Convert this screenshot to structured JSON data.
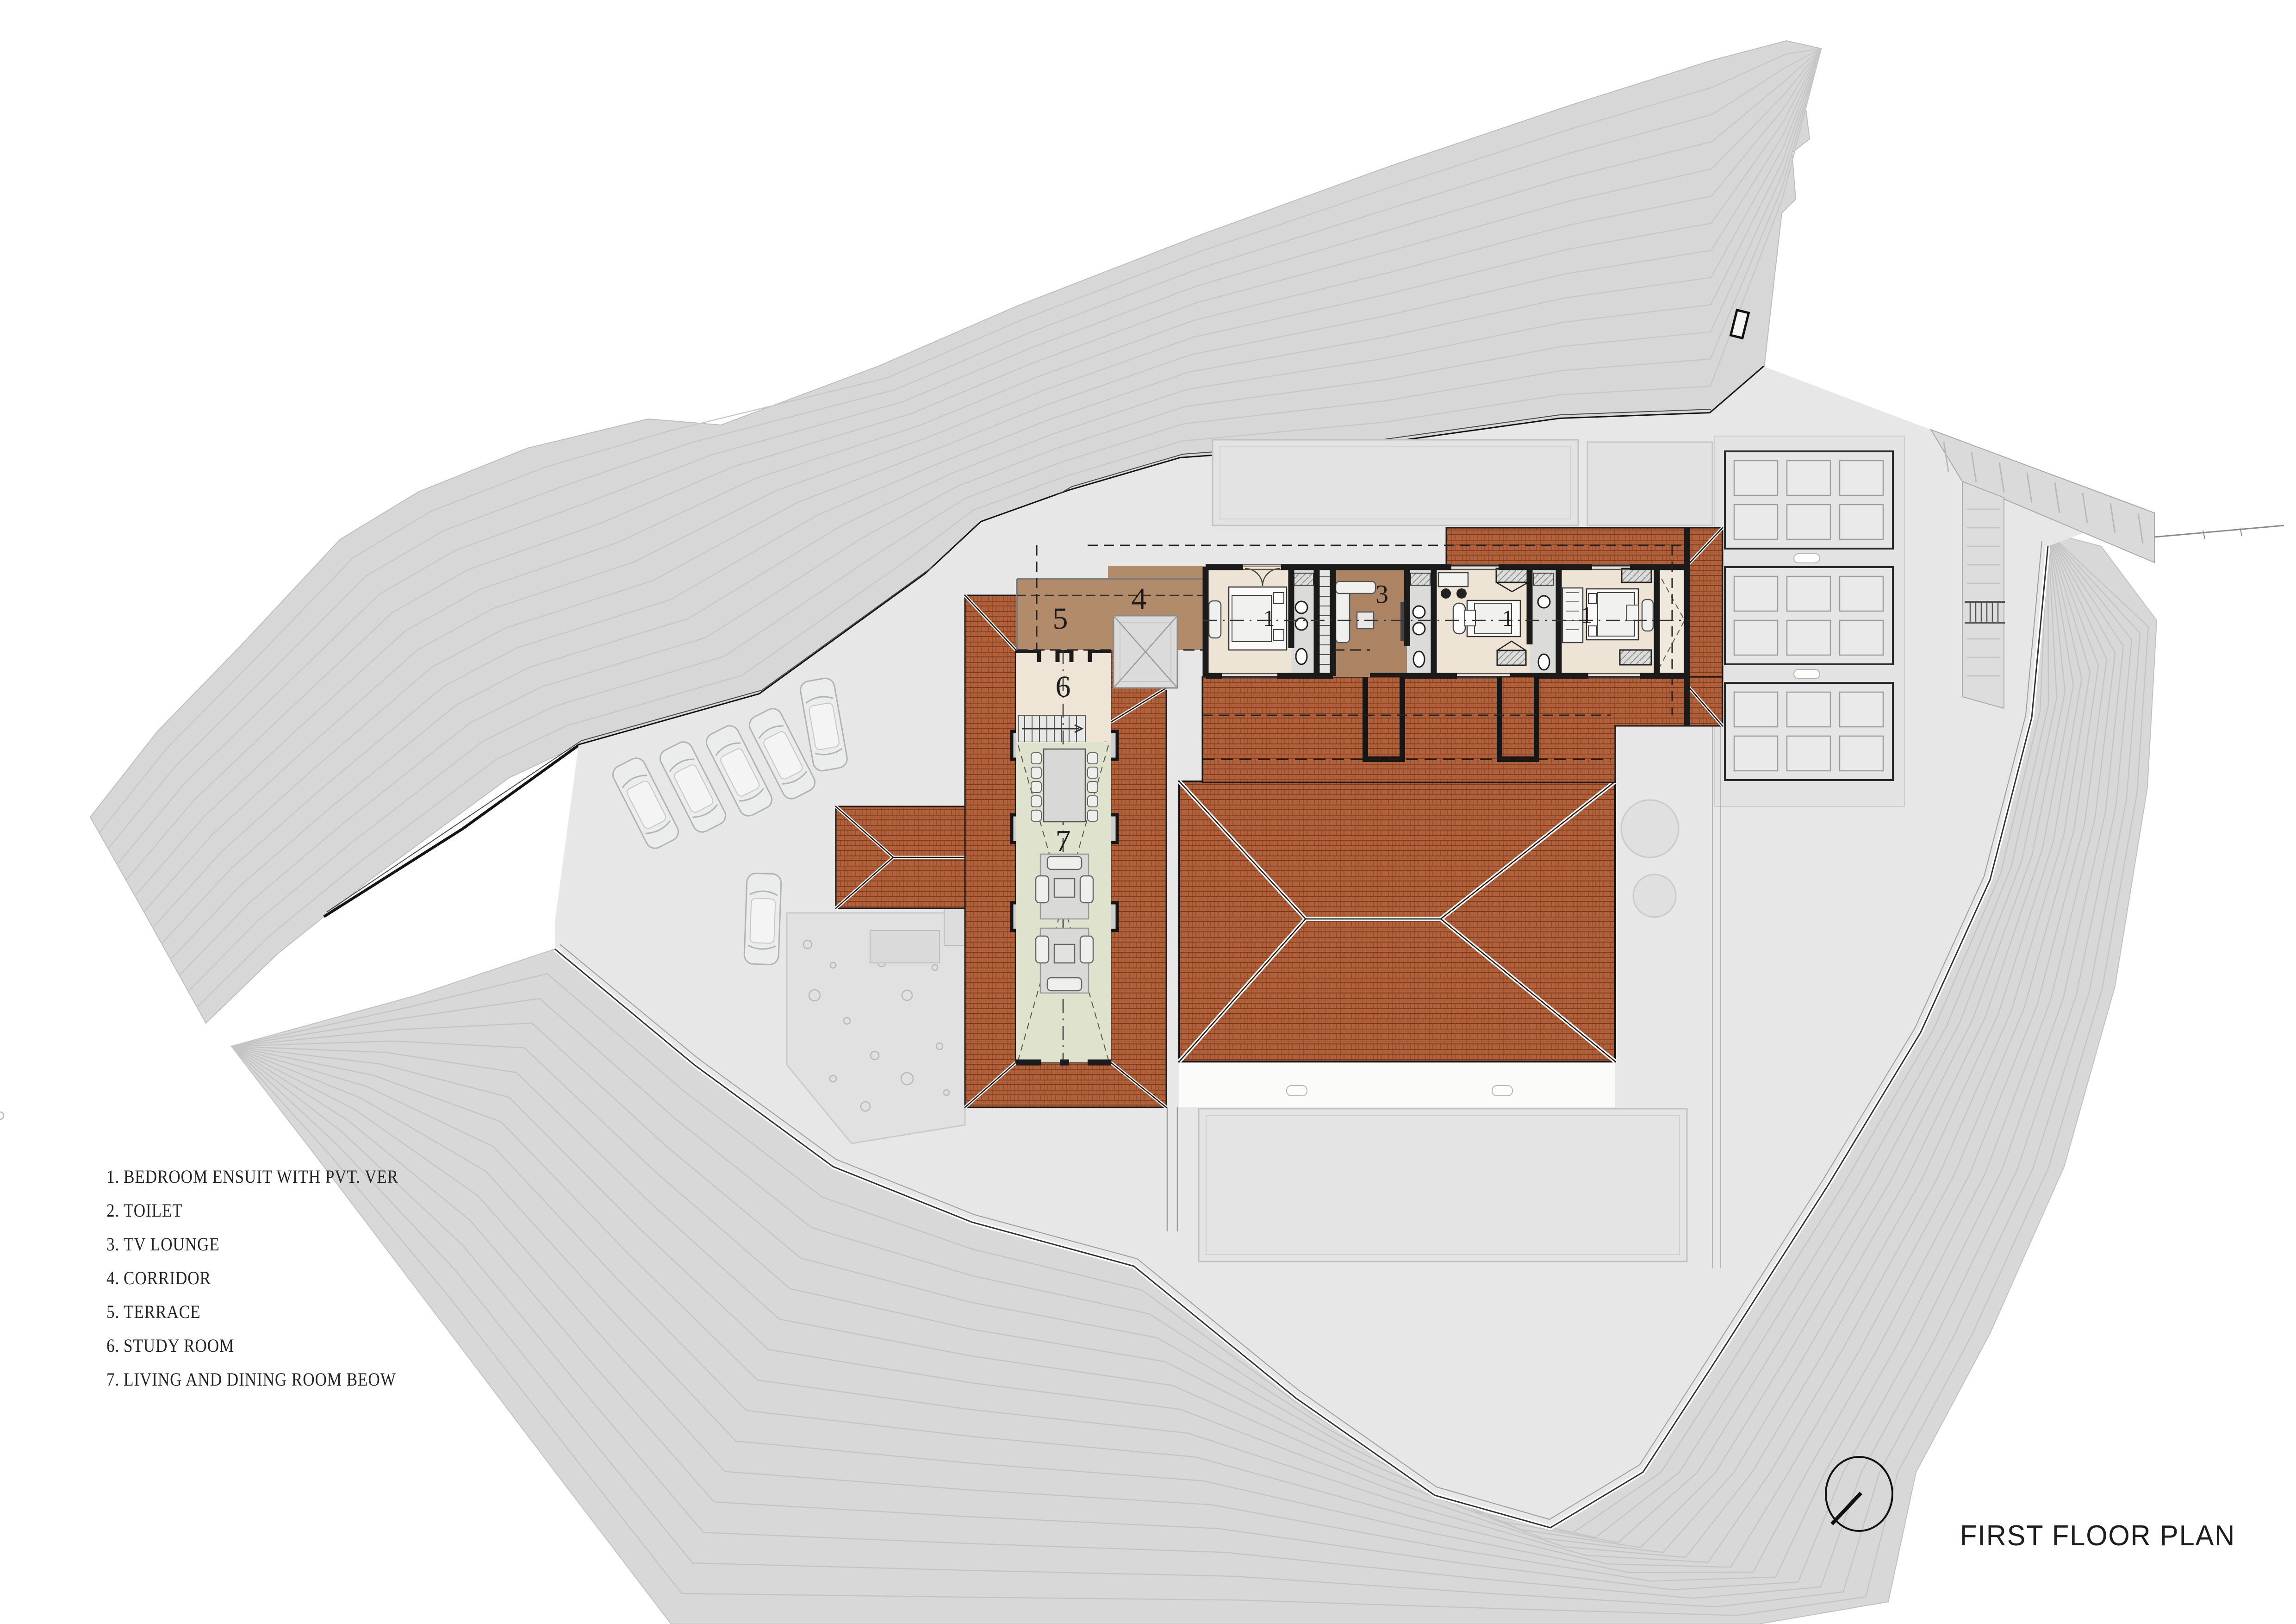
{
  "title": "FIRST FLOOR PLAN",
  "legend": {
    "items": [
      {
        "num": "1.",
        "text": "BEDROOM ENSUIT WITH PVT. VER"
      },
      {
        "num": "2.",
        "text": "TOILET"
      },
      {
        "num": "3.",
        "text": "TV LOUNGE"
      },
      {
        "num": "4.",
        "text": "CORRIDOR"
      },
      {
        "num": "5.",
        "text": "TERRACE"
      },
      {
        "num": "6.",
        "text": "STUDY ROOM"
      },
      {
        "num": "7.",
        "text": "LIVING AND DINING ROOM BEOW"
      }
    ]
  },
  "rooms": [
    {
      "number": "1",
      "name": "bedroom ensuit with pvt. ver (west)"
    },
    {
      "number": "1",
      "name": "bedroom ensuit with pvt. ver (middle)"
    },
    {
      "number": "1",
      "name": "bedroom ensuit with pvt. ver (east)"
    },
    {
      "number": "3",
      "name": "tv lounge"
    },
    {
      "number": "4",
      "name": "corridor"
    },
    {
      "number": "5",
      "name": "terrace"
    },
    {
      "number": "6",
      "name": "study room"
    },
    {
      "number": "7",
      "name": "living and dining room below"
    }
  ],
  "colors": {
    "roof_tile": "#b2613a",
    "roof_tile_joint": "#8c4826",
    "roof_tile_row": "#7c3d1f",
    "corridor_floor": "#b28b6b",
    "bedroom_floor": "#ede4d6",
    "living_floor": "#dfe3cd",
    "toilet_floor": "#dbdbd9",
    "terrain": "#d6d7d6",
    "platform": "#e6e7e6",
    "wall": "#1b1b1b"
  },
  "north_indicator": {
    "icon": "north-arrow-icon"
  }
}
